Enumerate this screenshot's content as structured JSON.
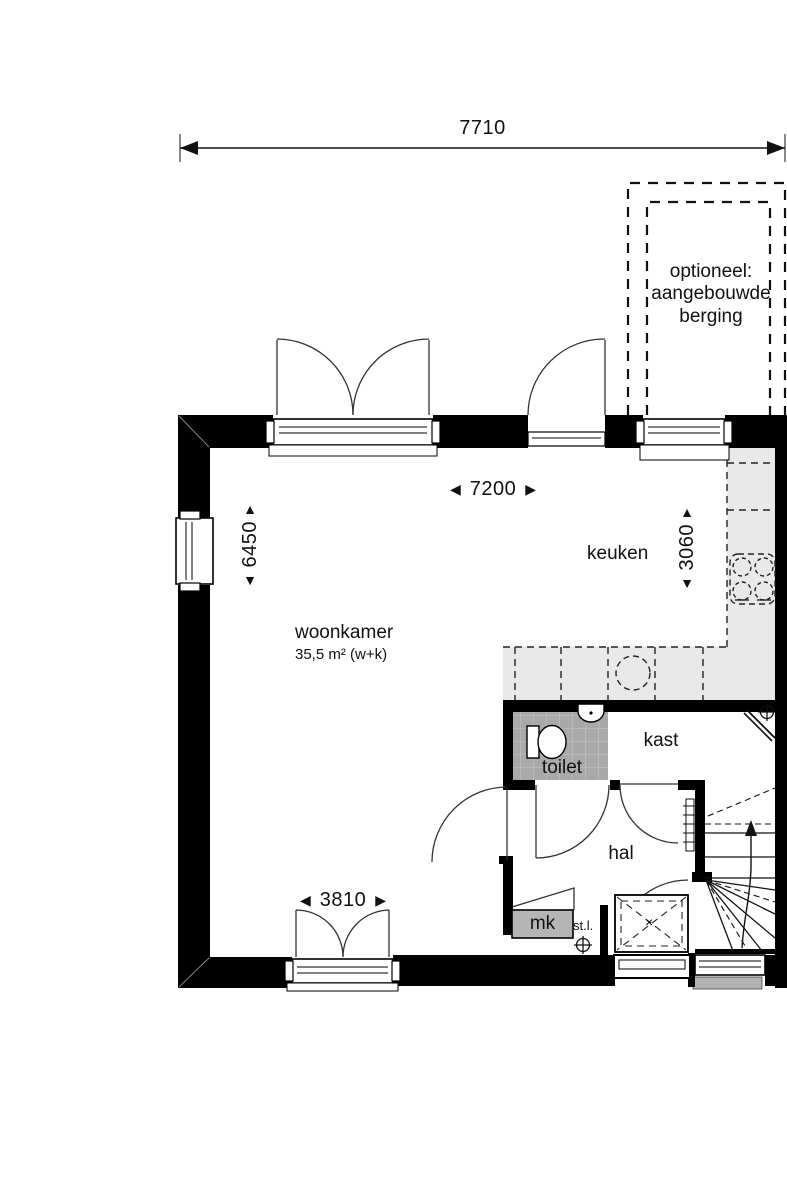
{
  "title": "begane grond plattegrond",
  "colors": {
    "wall": "#000000",
    "counter": "#e9e9e9",
    "tile": "#a9a9a9",
    "mk": "#b5b5b5",
    "step": "#b3b3b3",
    "line": "#1a1a1a",
    "bg": "#ffffff"
  },
  "icons": {
    "dim_left": "◀",
    "dim_right": "▶",
    "dim_up": "▲",
    "dim_down": "▼",
    "crawl_hatch_mark": "×"
  },
  "dimensions": {
    "overall_width": "7710",
    "interior_width": "7200",
    "living_depth": "6450",
    "kitchen_depth": "3060",
    "rear_doors_width": "3810"
  },
  "rooms": {
    "living": {
      "label": "woonkamer",
      "area": "35,5 m² (w+k)"
    },
    "kitchen": {
      "label": "keuken"
    },
    "toilet": {
      "label": "toilet"
    },
    "closet": {
      "label": "kast"
    },
    "hall": {
      "label": "hal"
    },
    "meter_cupboard": {
      "label": "mk"
    },
    "riser_duct": {
      "label": "st.l."
    },
    "optional_storage": {
      "label": "optioneel:\naangebouwde\nberging"
    }
  }
}
